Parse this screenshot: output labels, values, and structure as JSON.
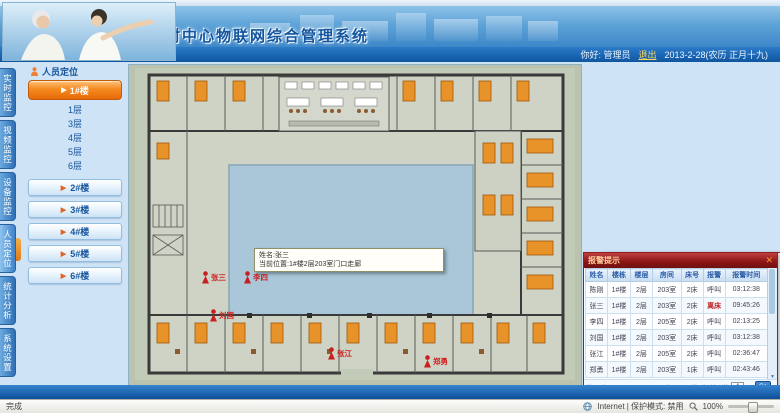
{
  "colors": {
    "header_blue": "#3d87c8",
    "subbar_blue": "#0f56a0",
    "button_orange": "#f58a20",
    "alarm_panel_red": "#8a1414",
    "alarm_text_red": "#d02020",
    "link_blue": "#14549c"
  },
  "header": {
    "title": "楼村中心物联网综合管理系统",
    "greeting": "你好: 管理员",
    "logout_label": "退出",
    "date_text": "2013-2-28(农历 正月十九)"
  },
  "sidebar": {
    "panel_title": "人员定位",
    "tabs": [
      {
        "label": "实时监控",
        "active": false
      },
      {
        "label": "视频监控",
        "active": false
      },
      {
        "label": "设备监控",
        "active": false
      },
      {
        "label": "人员定位",
        "active": true
      },
      {
        "label": "统计分析",
        "active": false
      },
      {
        "label": "系统设置",
        "active": false
      }
    ],
    "active_building": "1#楼",
    "floors": [
      {
        "label": "1层",
        "alarm": false
      },
      {
        "label": "2层",
        "alarm": true
      },
      {
        "label": "3层",
        "alarm": false
      },
      {
        "label": "4层",
        "alarm": false
      },
      {
        "label": "5层",
        "alarm": false
      },
      {
        "label": "6层",
        "alarm": false
      }
    ],
    "other_buildings": [
      "2#楼",
      "3#楼",
      "4#楼",
      "5#楼",
      "6#楼"
    ]
  },
  "plan": {
    "tooltip": {
      "line1": "姓名:张三",
      "line2": "当前位置:1#楼2层203室门口走廊"
    },
    "persons": [
      {
        "name": "张三",
        "x": 72,
        "y": 206
      },
      {
        "name": "李四",
        "x": 114,
        "y": 206
      },
      {
        "name": "刘国",
        "x": 80,
        "y": 244
      },
      {
        "name": "张江",
        "x": 198,
        "y": 282
      },
      {
        "name": "郑勇",
        "x": 294,
        "y": 290
      }
    ]
  },
  "alarm_panel": {
    "title": "报警提示",
    "close_label": "✕",
    "columns": [
      "姓名",
      "楼栋",
      "楼层",
      "房间",
      "床号",
      "报警",
      "报警时间"
    ],
    "rows": [
      [
        "陈刚",
        "1#楼",
        "2层",
        "203室",
        "2床",
        "呼叫",
        "03:12:38"
      ],
      [
        "张三",
        "1#楼",
        "2层",
        "203室",
        "2床",
        "离床",
        "09:45:26"
      ],
      [
        "李四",
        "1#楼",
        "2层",
        "205室",
        "2床",
        "呼叫",
        "02:13:25"
      ],
      [
        "刘国",
        "1#楼",
        "2层",
        "203室",
        "2床",
        "呼叫",
        "03:12:38"
      ],
      [
        "张江",
        "1#楼",
        "2层",
        "205室",
        "2床",
        "呼叫",
        "02:36:47"
      ],
      [
        "郑勇",
        "1#楼",
        "2层",
        "203室",
        "1床",
        "呼叫",
        "02:43:46"
      ]
    ],
    "pagination": {
      "first": "首页",
      "prev": "上一页",
      "next": "下一页",
      "last": "尾页",
      "page_info": "页次:1/1页",
      "total": "共6条",
      "goto_prefix": "转到第",
      "page_value": "1",
      "goto_suffix": "页",
      "go_label": "Go"
    }
  },
  "statusbar": {
    "left_text": "完成",
    "zone_text": "Internet | 保护模式: 禁用",
    "zoom_text": "100%"
  }
}
